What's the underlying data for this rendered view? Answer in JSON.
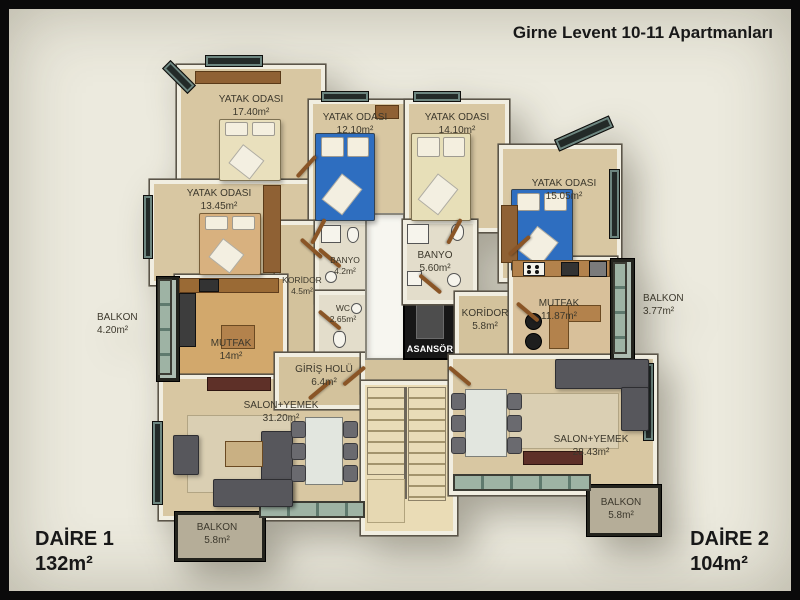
{
  "header": {
    "title": "Girne Levent 10-11 Apartmanları"
  },
  "footer": {
    "apartment_1": {
      "name": "DAİRE 1",
      "area": "132m²"
    },
    "apartment_2": {
      "name": "DAİRE 2",
      "area": "104m²"
    }
  },
  "rooms": {
    "d1_bedroom_1": {
      "label": "YATAK ODASI",
      "area": "17.40m²"
    },
    "d1_bedroom_2": {
      "label": "YATAK ODASI",
      "area": "13.45m²"
    },
    "d1_bedroom_3": {
      "label": "YATAK ODASI",
      "area": "12.10m²"
    },
    "d1_corridor": {
      "label": "KORİDOR",
      "area": "4.5m²"
    },
    "d1_bathroom": {
      "label": "BANYO",
      "area": "4.2m²"
    },
    "d1_wc": {
      "label": "WC",
      "area": "2.65m²"
    },
    "d1_kitchen": {
      "label": "MUTFAK",
      "area": "14m²"
    },
    "d1_entry_hall": {
      "label": "GİRİŞ HOLÜ",
      "area": "6.4m²"
    },
    "d1_living": {
      "label": "SALON+YEMEK",
      "area": "31.20m²"
    },
    "d1_balcony_left": {
      "label": "BALKON",
      "area": "4.20m²"
    },
    "d1_balcony_bottom": {
      "label": "BALKON",
      "area": "5.8m²"
    },
    "d2_bedroom_1": {
      "label": "YATAK ODASI",
      "area": "14.10m²"
    },
    "d2_bedroom_2": {
      "label": "YATAK ODASI",
      "area": "15.05m²"
    },
    "d2_bathroom": {
      "label": "BANYO",
      "area": "5.60m²"
    },
    "d2_corridor": {
      "label": "KORİDOR",
      "area": "5.8m²"
    },
    "d2_kitchen": {
      "label": "MUTFAK",
      "area": "11.87m²"
    },
    "d2_living": {
      "label": "SALON+YEMEK",
      "area": "28.43m²"
    },
    "d2_balcony_right": {
      "label": "BALKON",
      "area": "3.77m²"
    },
    "d2_balcony_bottom": {
      "label": "BALKON",
      "area": "5.8m²"
    }
  },
  "elevator": {
    "label": "ASANSÖR"
  },
  "colors": {
    "background": "#ECEADE",
    "frame": "#0A0A0A",
    "floor_tan": "#D8C7A2",
    "wall_white": "#F1EEE1",
    "wood_brown": "#9A6A35",
    "bed_blue": "#2E6EC0",
    "bed_cream": "#E9E0BD",
    "bed_tan": "#D8B17F",
    "sofa_gray": "#57575C",
    "balcony_gray": "#B5AD98",
    "glass_green": "#9EB3A4",
    "elevator_black": "#171717",
    "text_dark": "#3C382C"
  }
}
